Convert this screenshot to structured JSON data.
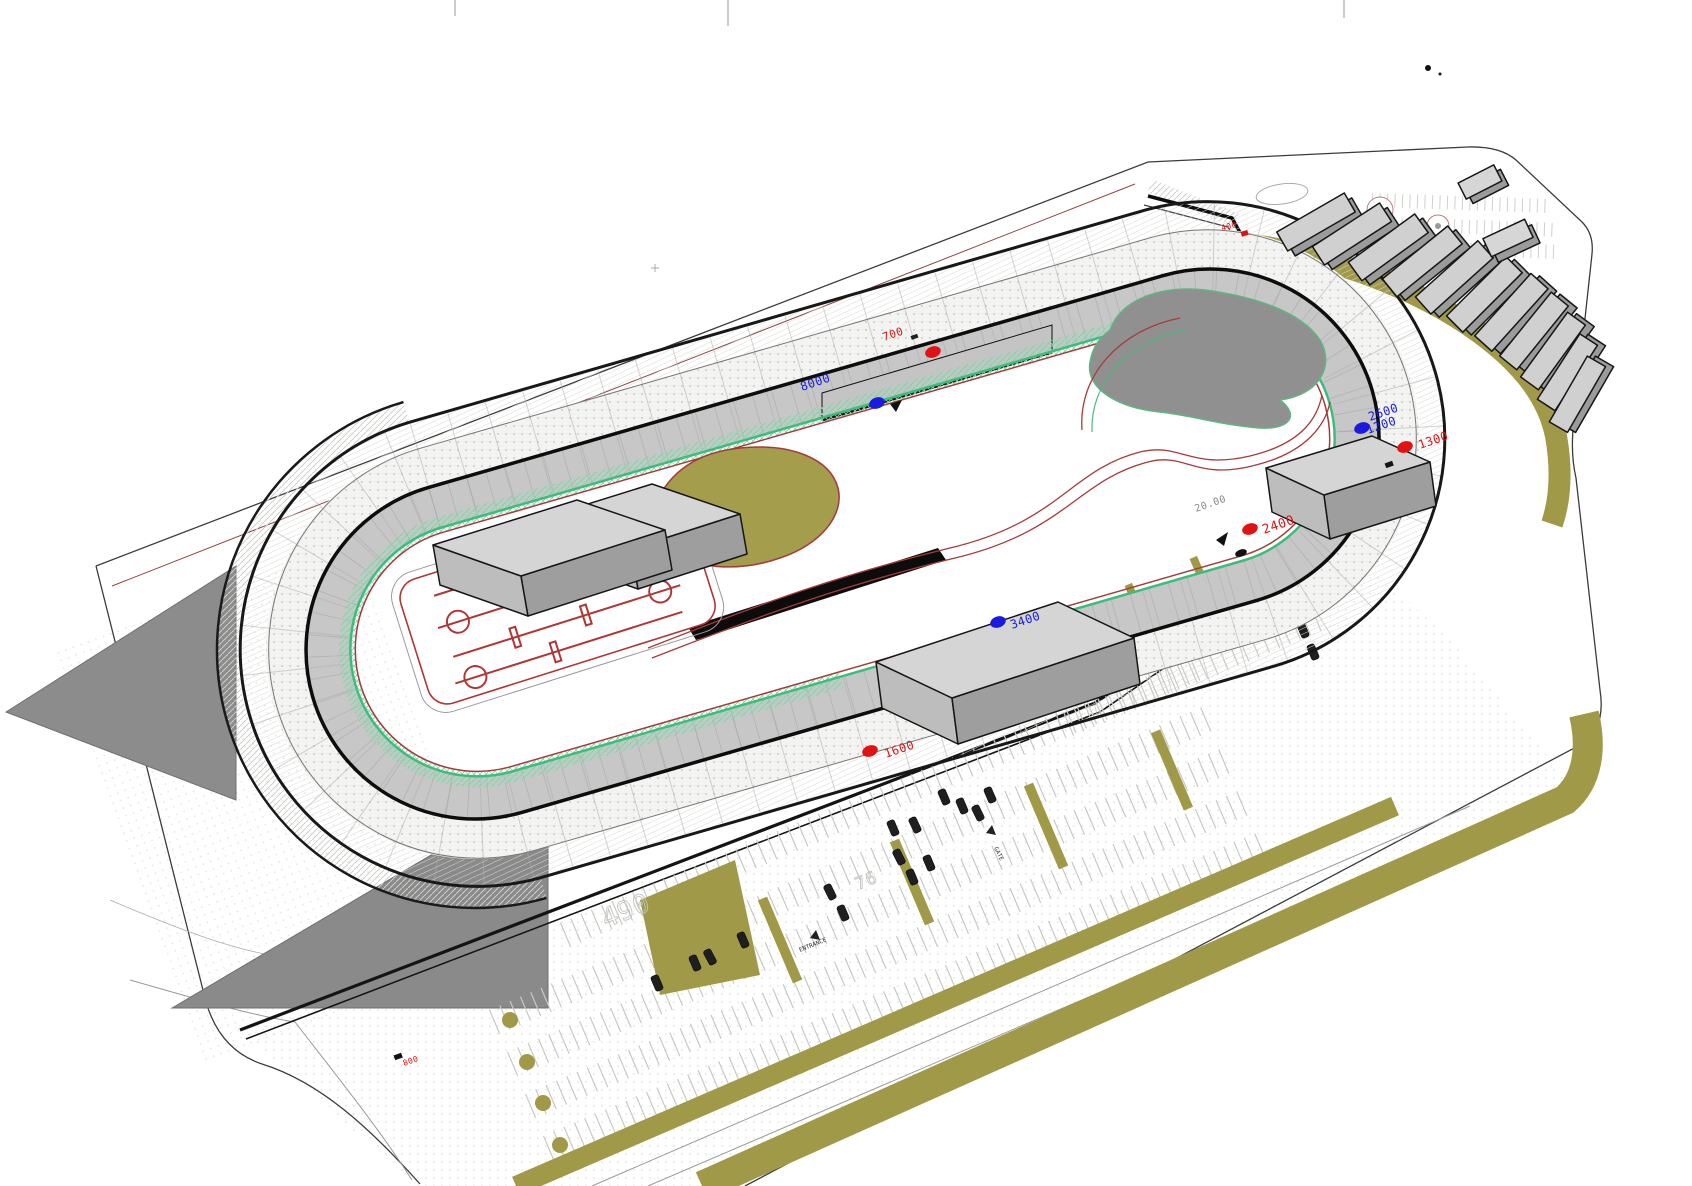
{
  "drawing": {
    "kind": "3D axonometric site plan",
    "subject": "Oval speedway race track facility with infield paddock, grandstand row, parking lots and access roads"
  },
  "palette": {
    "track_pavement": "#c7c7c7",
    "wall_black": "#141414",
    "infield_edge_green": "#3dbd7d",
    "road_line_red": "#a63a3a",
    "landscape_olive": "#a09a48",
    "pond_gray": "#909090",
    "building_top_gray": "#d5d5d5",
    "station_marker_red": "#e01212",
    "station_marker_blue": "#1b1bdf"
  },
  "stations": [
    {
      "color": "red",
      "text": "400"
    },
    {
      "color": "red",
      "text": "700"
    },
    {
      "color": "blue",
      "text": "8000"
    },
    {
      "color": "blue",
      "text": "2600"
    },
    {
      "color": "blue",
      "text": "1200"
    },
    {
      "color": "red",
      "text": "1300"
    },
    {
      "color": "red",
      "text": "2400"
    },
    {
      "color": "blue",
      "text": "3400"
    },
    {
      "color": "red",
      "text": "1600"
    },
    {
      "color": "red",
      "text": "800"
    }
  ],
  "measurements": {
    "offset_width": "20.00",
    "contour": "490",
    "lot_number": "76",
    "entrance": "ENTRANCE",
    "gate": "GATE"
  }
}
